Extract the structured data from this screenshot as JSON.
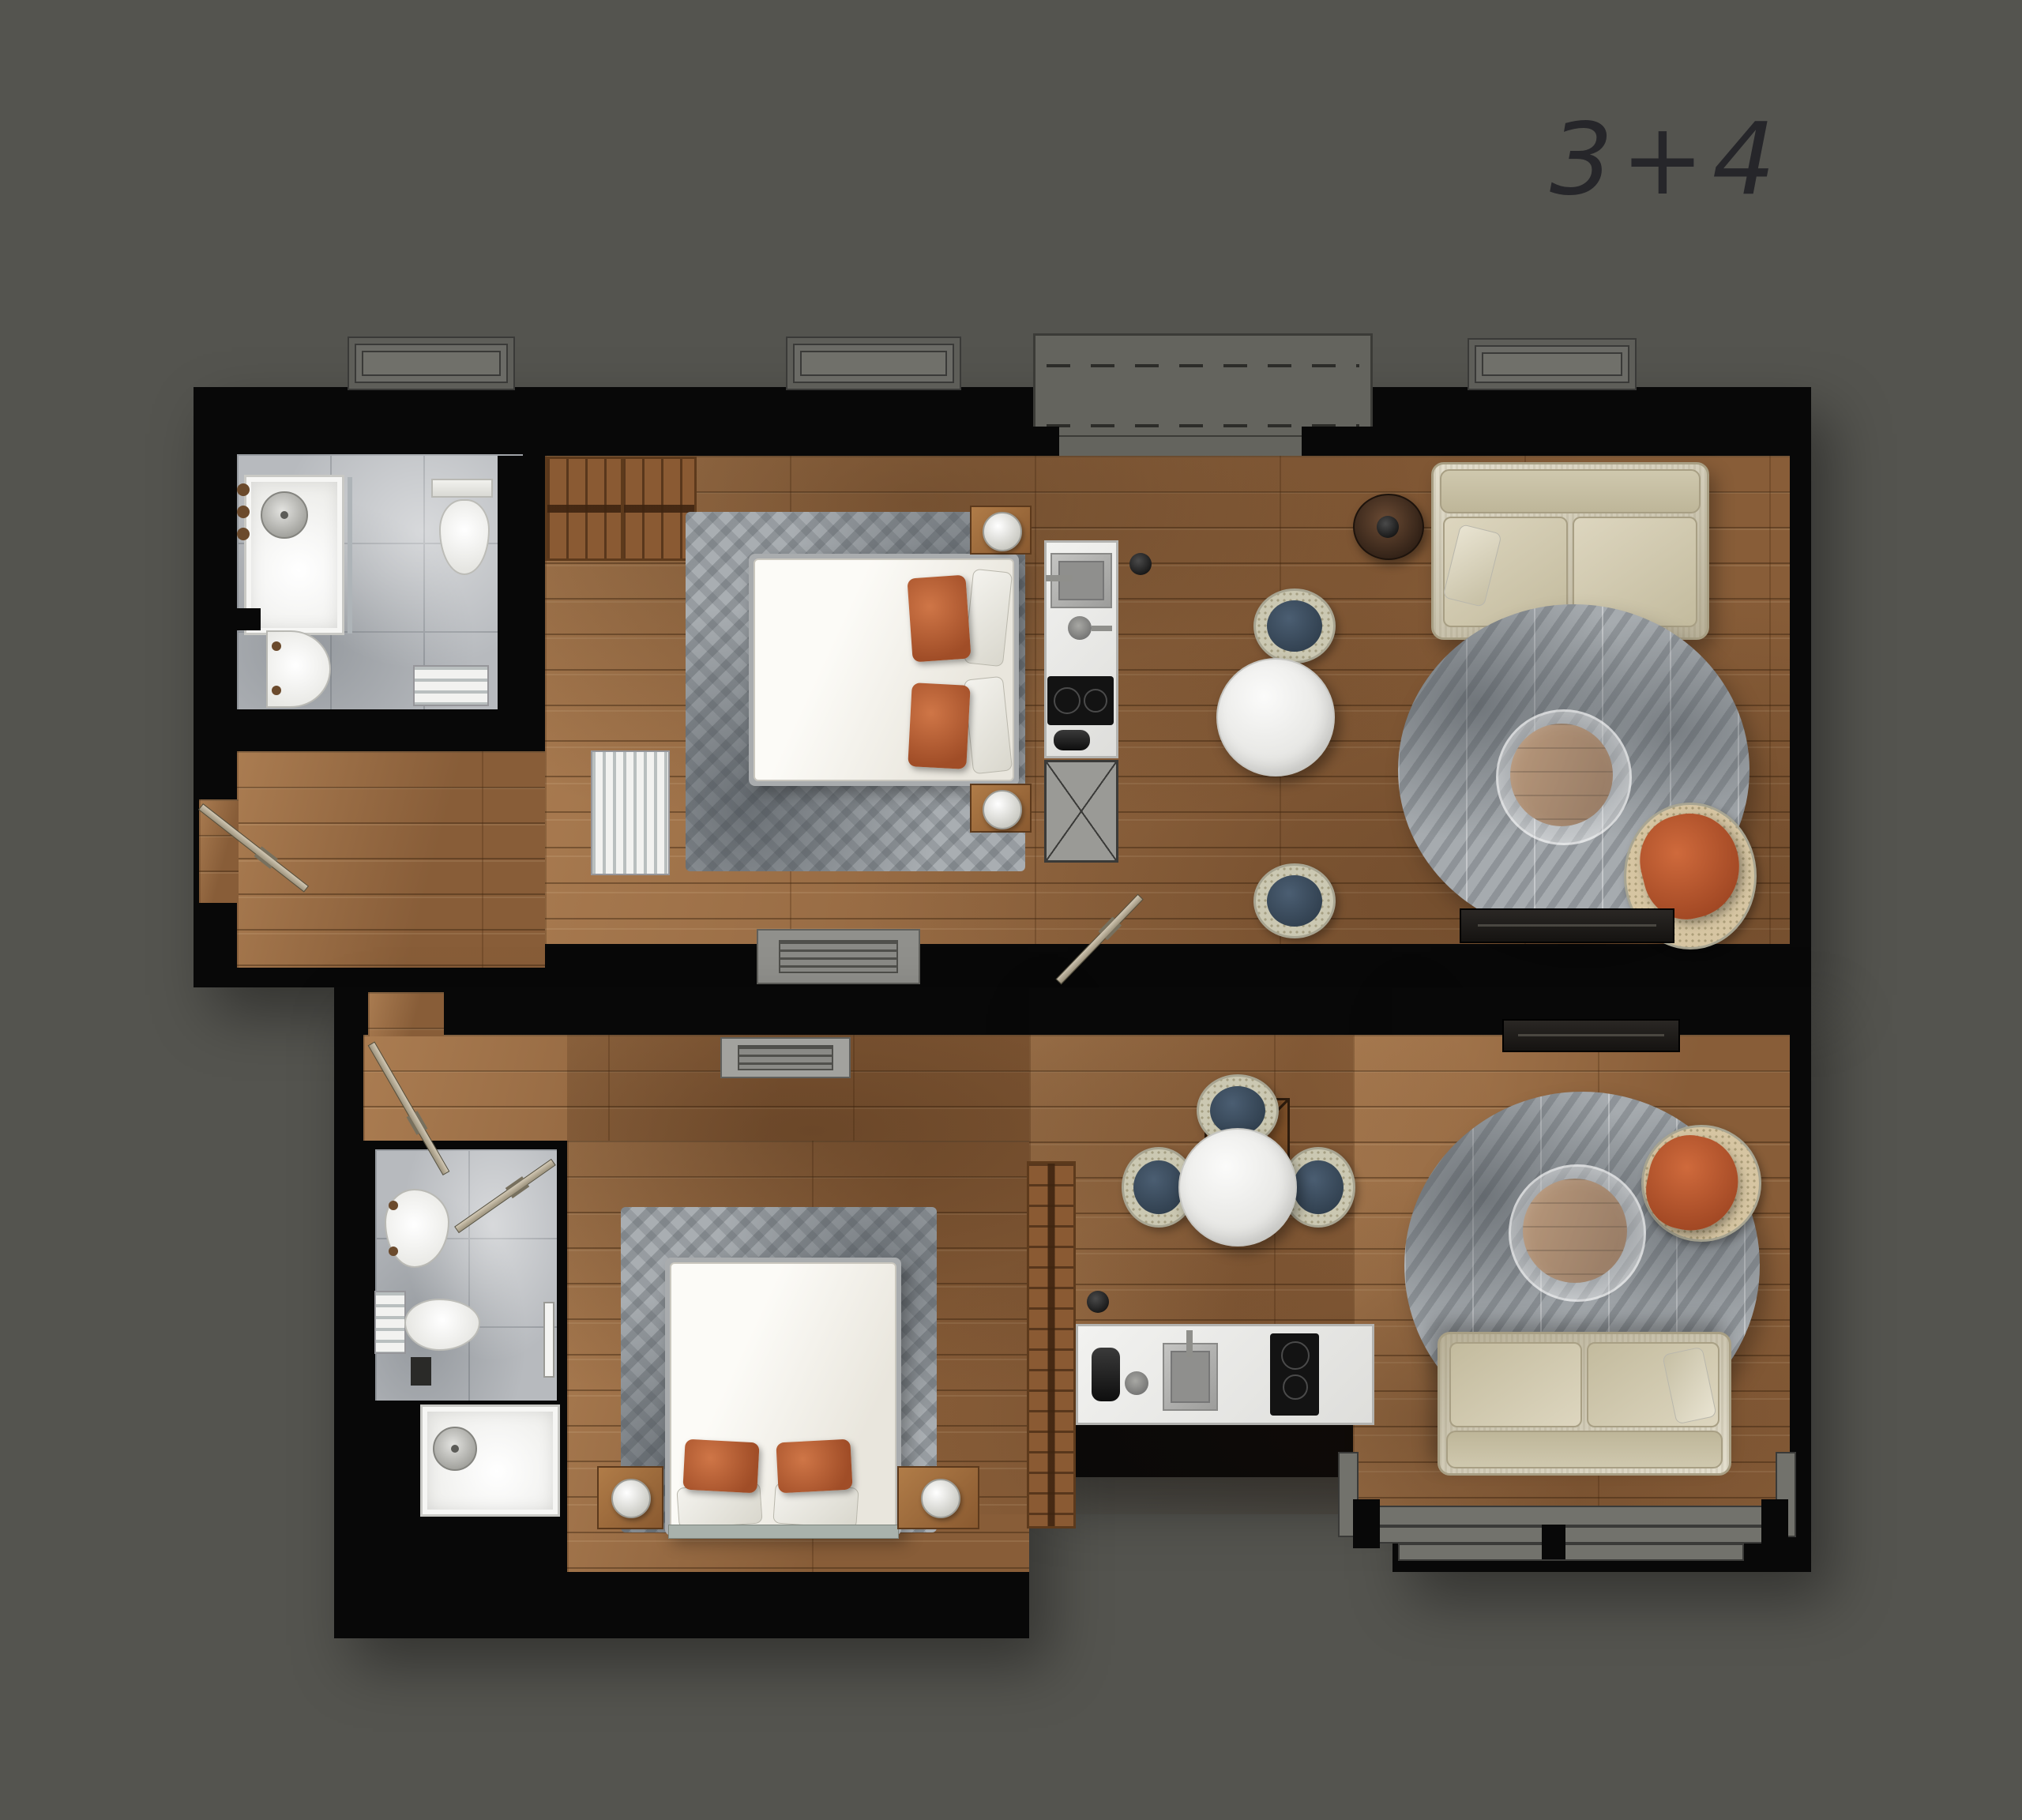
{
  "title": "3+4",
  "palette": {
    "background": "#54544f",
    "wall": "#080808",
    "wood_floor": "#9a6b42",
    "tile_floor": "#b7babe",
    "rug_gray": "#a9aeb2",
    "duvet_white": "#f6f4ee",
    "pillow_orange": "#b65c33",
    "sofa_cream": "#d8d1b9",
    "dining_chair_blue": "#3e5266",
    "chair_weave_cream": "#cbc8b2",
    "armchair_orange": "#c05c32",
    "kitchen_counter_white": "#ececea",
    "cooktop_black": "#131313",
    "terrace_gray": "#64645e",
    "door_leaf_tan": "#c3b9a4",
    "wardrobe_brown": "#8a5a33"
  },
  "units": [
    {
      "id": "unit-3",
      "position": "top",
      "rooms": [
        "hallway",
        "bathroom",
        "wardrobe",
        "bedroom",
        "kitchenette",
        "dining-area",
        "living-area",
        "balcony"
      ],
      "furniture": [
        "shower",
        "toilet",
        "washbasin",
        "towel-radiator",
        "hanger-wardrobe",
        "radiator",
        "double-bed",
        "orange-pillows",
        "nightstands-with-lamps",
        "kitchen-sink",
        "induction-cooktop",
        "appliance-cabinet",
        "round-dining-table",
        "two-blue-dining-chairs",
        "round-side-table",
        "cream-sofa",
        "round-gray-rug",
        "glass-coffee-table",
        "orange-armchair",
        "tv-console",
        "floor-vent",
        "entry-door",
        "interior-door"
      ]
    },
    {
      "id": "unit-4",
      "position": "bottom",
      "rooms": [
        "entry-hall",
        "bathroom",
        "bedroom",
        "wardrobe",
        "kitchenette",
        "dining-area",
        "living-area"
      ],
      "furniture": [
        "washbasin",
        "toilet",
        "towel-radiator",
        "towel-rail",
        "shower",
        "double-bed",
        "orange-pillows",
        "nightstands-with-lamps",
        "hanger-wardrobe",
        "service-shaft",
        "kettle",
        "kitchen-sink",
        "induction-cooktop",
        "round-dining-table",
        "three-blue-dining-chairs",
        "round-gray-rug",
        "glass-coffee-table",
        "orange-armchair",
        "cream-sofa",
        "tv-console",
        "floor-vent",
        "bay-window",
        "entry-door",
        "bathroom-door"
      ]
    }
  ]
}
